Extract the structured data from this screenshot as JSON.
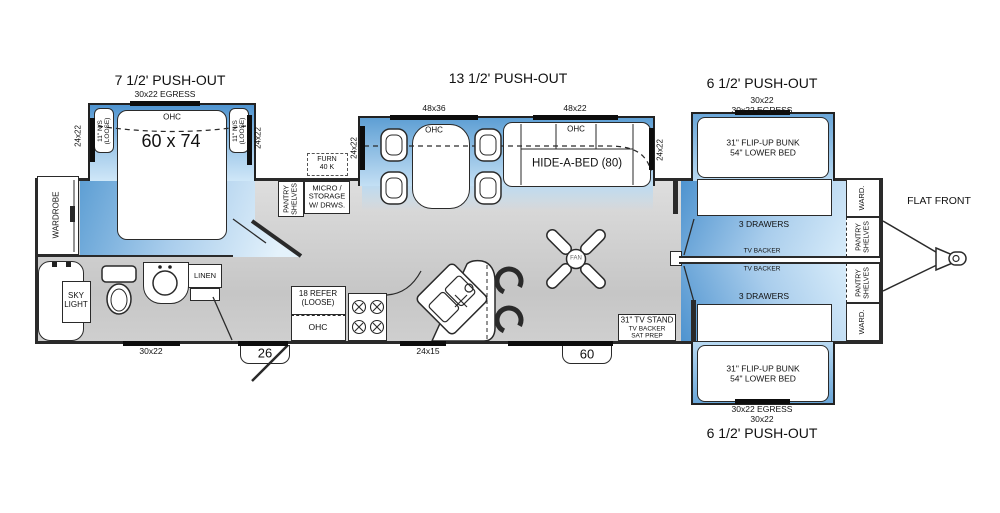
{
  "colors": {
    "pushout_blue": "#4a90cd",
    "pushout_blue_light": "#cfe7f8",
    "floor_gray": "#c9c9c9",
    "wall": "#2a2a2a"
  },
  "titles": {
    "bedroom": "7 1/2' PUSH-OUT",
    "living": "13 1/2' PUSH-OUT",
    "bunk_top": "6 1/2' PUSH-OUT",
    "bunk_bottom": "6 1/2' PUSH-OUT",
    "flat_front": "FLAT FRONT"
  },
  "bedroom": {
    "egress": "30x22 EGRESS",
    "ohc": "OHC",
    "bed_size": "60 x 74",
    "ns_l1": "11\" N/S",
    "ns_l2": "(LOOSE)",
    "win_side": "24x22",
    "wardrobe": "WARDROBE"
  },
  "bath": {
    "sky_l1": "SKY",
    "sky_l2": "LIGHT",
    "linen": "LINEN",
    "window": "30x22"
  },
  "kitchen": {
    "furn_l1": "FURN",
    "furn_l2": "40 K",
    "pantry_l1": "PANTRY",
    "pantry_l2": "SHELVES",
    "micro_l1": "MICRO /",
    "micro_l2": "STORAGE",
    "micro_l3": "W/ DRWS.",
    "refer_l1": "18 REFER",
    "refer_l2": "(LOOSE)",
    "ohc": "OHC",
    "window": "24x15",
    "entry_door": "26"
  },
  "living": {
    "win_dinette": "48x36",
    "ohc_dinette": "OHC",
    "win_sofa": "48x22",
    "ohc_sofa": "OHC",
    "sofa": "HIDE-A-BED (80)",
    "win_left": "24x22",
    "win_right": "24x22",
    "fan": "FAN",
    "tv_l1": "31\" TV STAND",
    "tv_l2": "TV BACKER",
    "tv_l3": "SAT PREP",
    "door": "60"
  },
  "bunks": {
    "window": "30x22",
    "egress": "30x22 EGRESS",
    "bunk_l1": "31\" FLIP-UP BUNK",
    "bunk_l2": "54\" LOWER BED",
    "drawers": "3 DRAWERS",
    "tv_backer": "TV BACKER",
    "ward": "WARD.",
    "pantry_l1": "PANTRY",
    "pantry_l2": "SHELVES"
  }
}
